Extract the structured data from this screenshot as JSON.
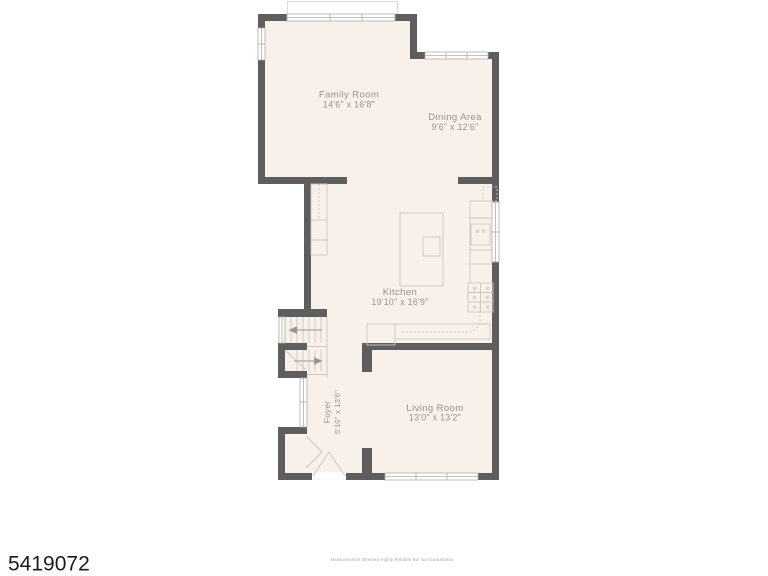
{
  "listing": {
    "mls_number": "5419072",
    "disclaimer": "Measurements Deemed Highly Reliable But Not Guaranteed"
  },
  "floor_plan": {
    "rooms": [
      {
        "name": "Family Room",
        "dimensions": "14'6\" x 16'8\""
      },
      {
        "name": "Dining Area",
        "dimensions": "9'6\" x 12'6\""
      },
      {
        "name": "Kitchen",
        "dimensions": "19'10\" x 16'9\""
      },
      {
        "name": "Living Room",
        "dimensions": "13'0\" x 13'2\""
      },
      {
        "name": "Foyer",
        "dimensions": "5'10\" x 13'6\""
      }
    ],
    "features": [
      "stairs-up-arrow",
      "stairs-down-arrow",
      "kitchen-island",
      "sink",
      "range",
      "refrigerator-dashed",
      "pantry-shelves",
      "entry-closet-bifold",
      "double-entry-door",
      "windows",
      "deck-outline"
    ],
    "colors": {
      "wall": "#5e5e5e",
      "floor": "#f7f1ea",
      "fixture_line": "#cdc6be",
      "window_line": "#b3aca4",
      "label_text": "#97918a",
      "mls_text": "#1c1c1c",
      "disclaimer_text": "#a9a49e"
    }
  }
}
